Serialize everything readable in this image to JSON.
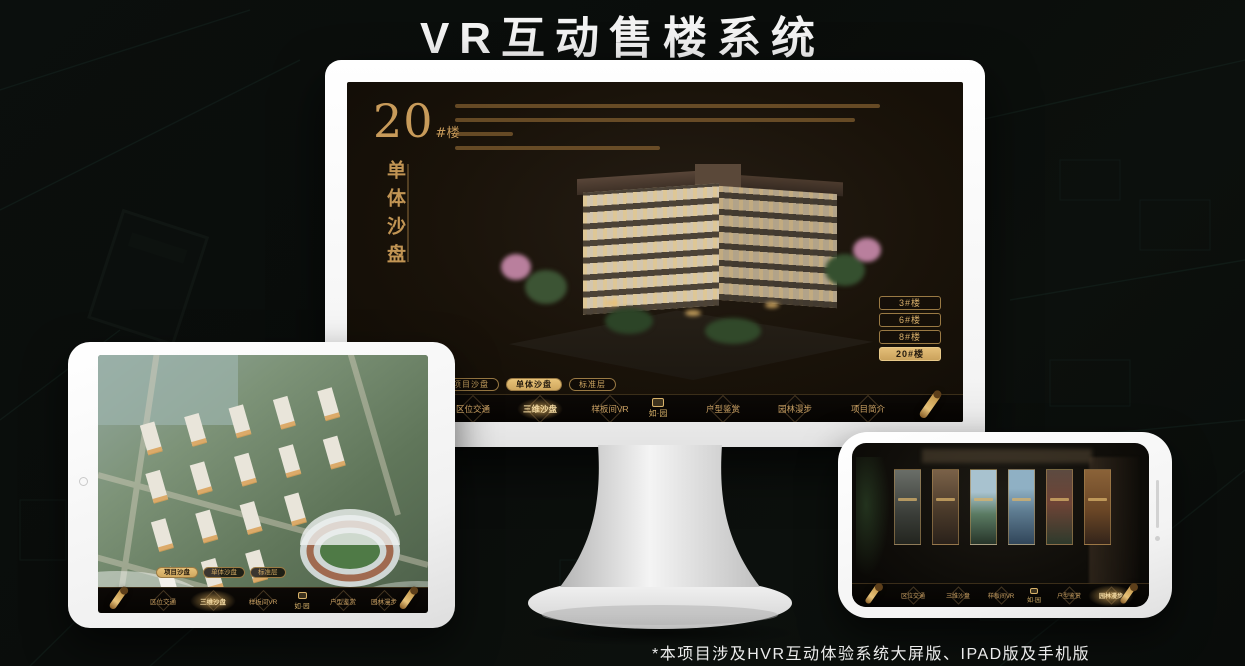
{
  "page": {
    "title": "VR互动售楼系统",
    "footnote": "*本项目涉及HVR互动体验系统大屏版、IPAD版及手机版"
  },
  "monitor": {
    "block_panel": {
      "number": "20",
      "suffix": "#楼",
      "subtitle": "单体沙盘"
    },
    "building_buttons": [
      {
        "label": "3#楼"
      },
      {
        "label": "6#楼"
      },
      {
        "label": "8#楼"
      },
      {
        "label": "20#楼"
      }
    ]
  },
  "sub_tabs": [
    {
      "label": "项目沙盘"
    },
    {
      "label": "单体沙盘"
    },
    {
      "label": "标准层"
    }
  ],
  "nav": {
    "items": [
      {
        "label": "区位交通"
      },
      {
        "label": "三维沙盘"
      },
      {
        "label": "样板间VR"
      },
      {
        "label": "户型鉴赏"
      },
      {
        "label": "园林漫步"
      },
      {
        "label": "项目简介"
      }
    ],
    "logo": "如·园"
  },
  "colors": {
    "gold_accent": "#c9a063",
    "gold_active": "#d8b26a",
    "screen_background": "#191209",
    "device_white": "#ffffff",
    "background_dark": "#0b0f0d"
  }
}
